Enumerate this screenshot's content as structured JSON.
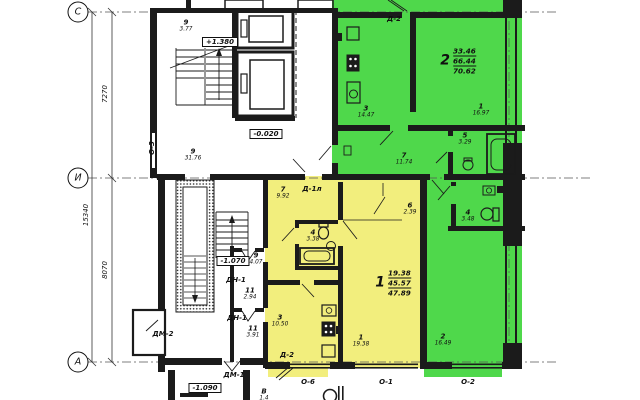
{
  "title": "floor-plan",
  "colors": {
    "apt1_fill": "#f2ee7d",
    "apt2_fill": "#4fd84b",
    "wall": "#1b1b1b"
  },
  "axes": {
    "c": "С",
    "i": "И",
    "a": "А"
  },
  "dims": {
    "total": "15340",
    "c_i": "7270",
    "i_a": "8070"
  },
  "levels": {
    "l1": "+1.380",
    "l2": "-0.020",
    "l3": "-1.070",
    "l4": "-1.090"
  },
  "apartments": {
    "apt1": {
      "num": "1",
      "living": "19.38",
      "total": "45.57",
      "overall": "47.89"
    },
    "apt2": {
      "num": "2",
      "living": "33.46",
      "total": "66.44",
      "overall": "70.62"
    }
  },
  "rooms": {
    "stair_upper": {
      "n": "9",
      "a": "3.77"
    },
    "corridor": {
      "n": "9",
      "a": "31.76"
    },
    "stair_lower": {
      "n": "9",
      "a": "4.07"
    },
    "lobby1": {
      "n": "11",
      "a": "2.94"
    },
    "lobby2": {
      "n": "11",
      "a": "3.91"
    },
    "apt2_kitchen": {
      "n": "3",
      "a": "14.47"
    },
    "apt2_living": {
      "n": "1",
      "a": "16.97"
    },
    "apt2_bath": {
      "n": "5",
      "a": "3.29"
    },
    "apt2_hall": {
      "n": "7",
      "a": "11.74"
    },
    "apt2_wc": {
      "n": "4",
      "a": "3.48"
    },
    "apt2_room2": {
      "n": "2",
      "a": "16.49"
    },
    "apt1_hall": {
      "n": "7",
      "a": "9.92"
    },
    "apt1_bath": {
      "n": "4",
      "a": "3.38"
    },
    "apt1_closet": {
      "n": "6",
      "a": "2.39"
    },
    "apt1_living": {
      "n": "1",
      "a": "19.38"
    },
    "apt1_kitchen": {
      "n": "3",
      "a": "10.50"
    },
    "balcony": {
      "n": "В",
      "a": "1.4"
    }
  },
  "doors": {
    "d2_top": "Д-2",
    "d1l": "Д-1л",
    "dn1_a": "ДН-1",
    "dn1_b": "ДН-1",
    "dm2": "ДМ-2",
    "dm1": "ДМ-1",
    "d2_bottom": "Д-2"
  },
  "windows": {
    "o3": "О-3",
    "o6": "О-6",
    "o1": "О-1",
    "o2": "О-2"
  }
}
